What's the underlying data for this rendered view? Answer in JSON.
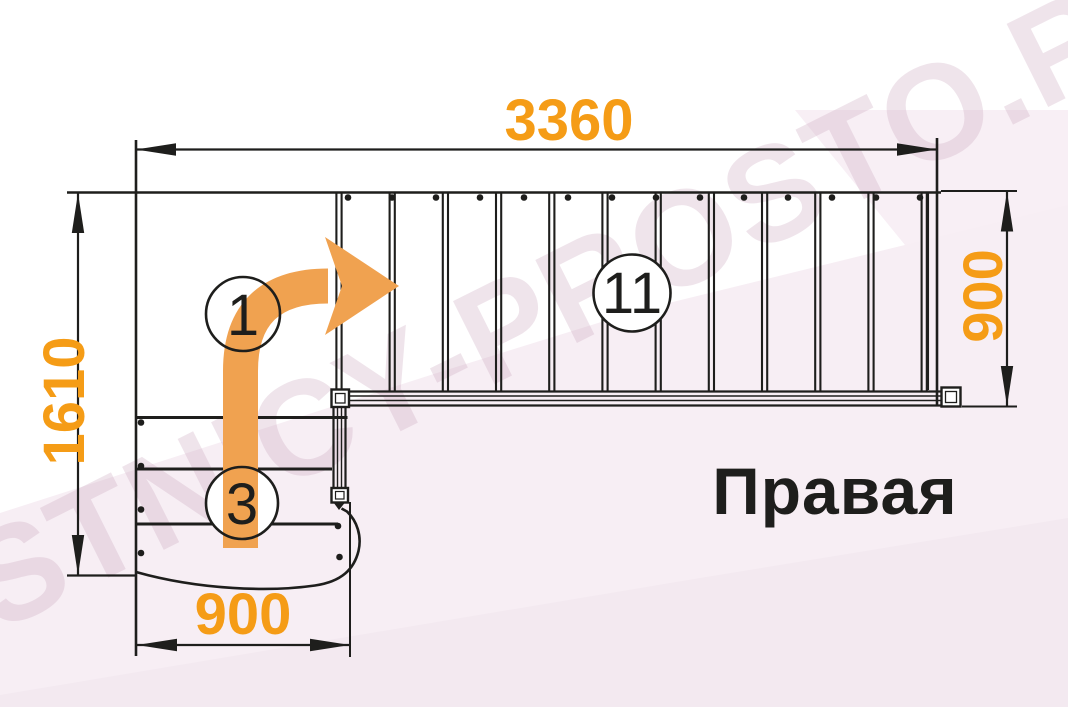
{
  "diagram": {
    "watermark": "LESTNICY-PROSTO.RU",
    "orientation_label": "Правая",
    "dim_top": "3360",
    "dim_left": "1610",
    "dim_right": "900",
    "dim_bottom": "900",
    "marker_first_step": "1",
    "marker_lower_steps": "3",
    "marker_upper_steps": "11",
    "top_flight_steps": 11,
    "top_flight_balusters": 14,
    "lower_flight_steps": 3,
    "colors": {
      "dimension_orange": "#f59c16",
      "arrow_orange": "#f0a250",
      "line_black": "#1e1e1c",
      "background_pink": "#f7eef4"
    }
  }
}
